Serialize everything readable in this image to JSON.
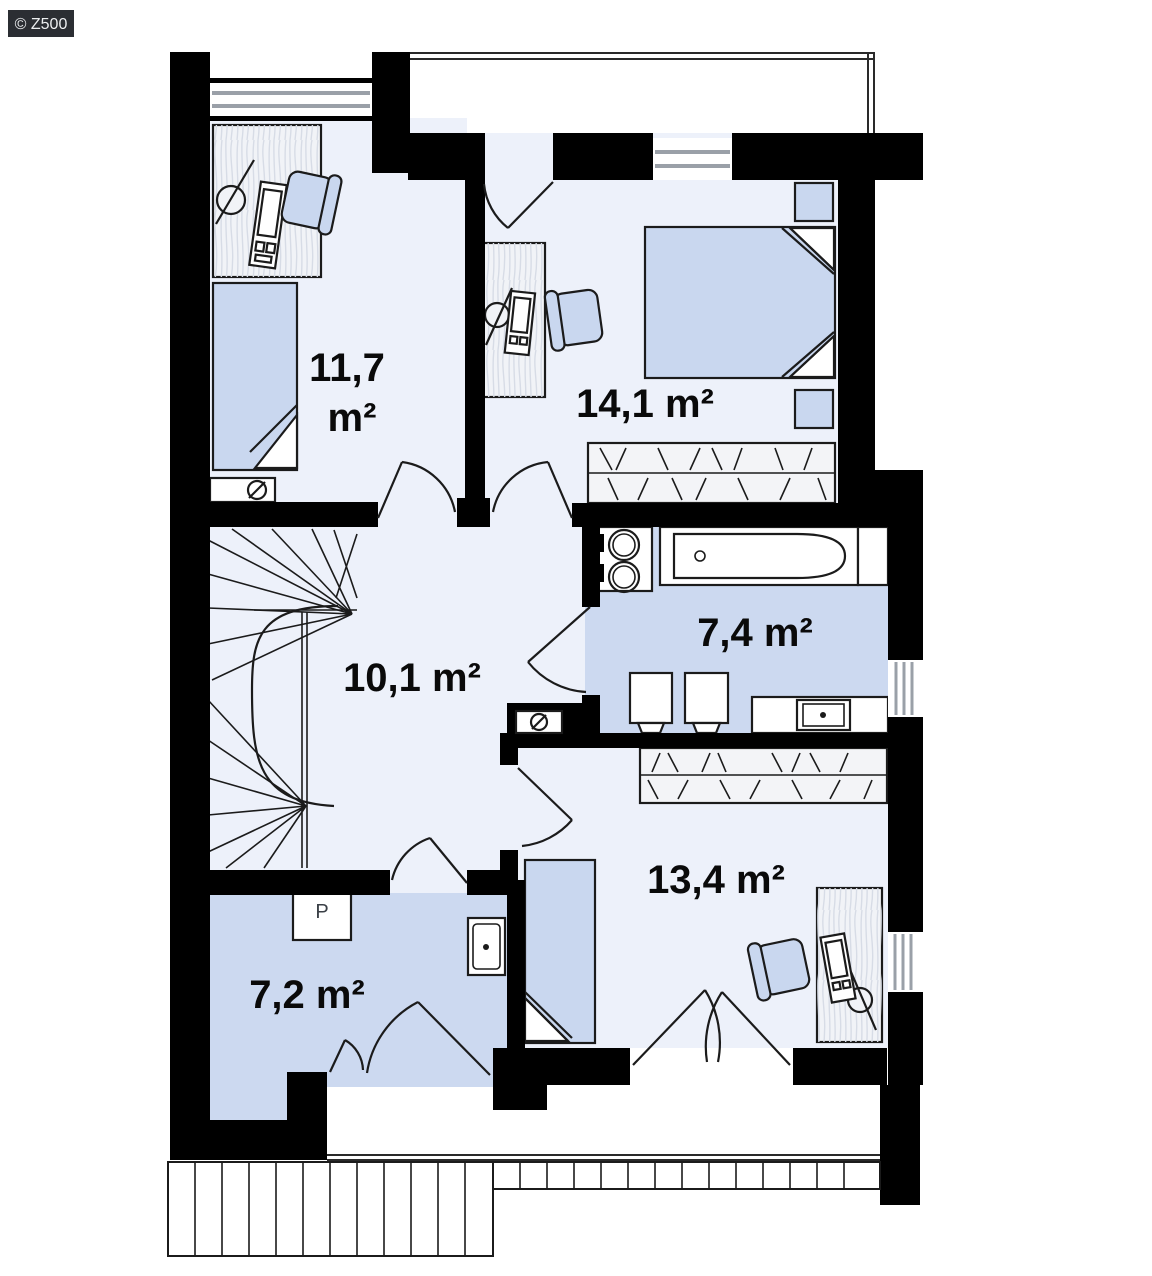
{
  "watermark": {
    "text": "© Z500"
  },
  "plan_title": "upper floor plan",
  "rooms": {
    "r117": {
      "name": "bedroom-top-left",
      "line1": "11,7",
      "line2": "m²"
    },
    "r141": {
      "name": "bedroom-top-right",
      "label": "14,1 m²"
    },
    "r101": {
      "name": "hall-stairs",
      "label": "10,1 m²"
    },
    "r74": {
      "name": "bathroom",
      "label": "7,4 m²"
    },
    "r134": {
      "name": "bedroom-bottom-right",
      "label": "13,4 m²"
    },
    "r72": {
      "name": "laundry-room",
      "label": "7,2 m²"
    }
  },
  "symbols": {
    "washer_label": "P",
    "vent_symbol": "circle-slash",
    "icon_names": [
      "single-bed",
      "double-bed",
      "desk",
      "office-chair",
      "wardrobe",
      "bathtub",
      "double-washbasin",
      "toilet",
      "bidet",
      "countertop-sink",
      "washing-machine",
      "staircase",
      "door-arc",
      "window",
      "balcony-railing",
      "terrace-railing",
      "vent-symbol"
    ]
  },
  "colors": {
    "wall": "#000000",
    "room_light": "#edf1fa",
    "room_medium": "#ccd9f0",
    "furniture_blue": "#c9d7ef",
    "wood_fill": "#f1f3f7",
    "window_line": "#9aa0a8",
    "badge_bg": "#2b2e33",
    "badge_text": "#eceef0",
    "label_text": "#0a0a0a"
  }
}
